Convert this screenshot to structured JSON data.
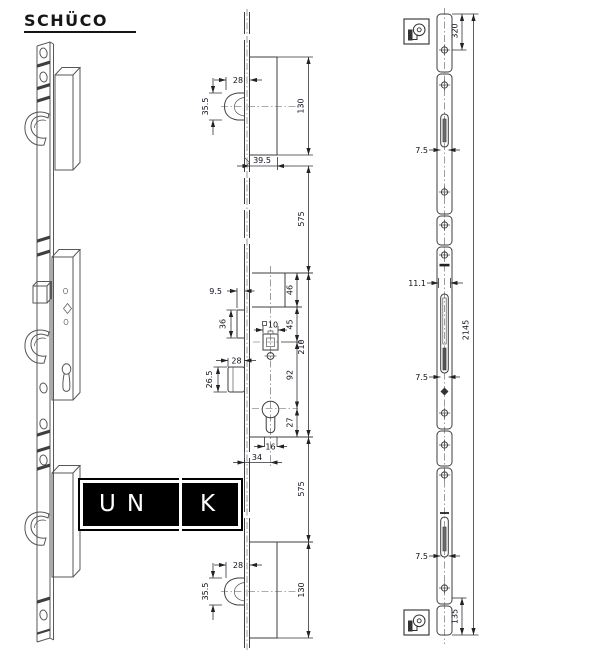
{
  "brand": {
    "name": "SCHÜCO"
  },
  "unik": {
    "full_text": "UNIK",
    "before_bar": "UN",
    "after_bar": "K"
  },
  "colors": {
    "line": "#3d3d3d",
    "dimension_text": "#10101c",
    "logo_bg": "#000000",
    "logo_text": "#ffffff"
  },
  "middle_drawing": {
    "top": {
      "hook_projection": "28",
      "hook_height": "35.5",
      "case_height": "130",
      "offset": "39.5"
    },
    "upper_span": "575",
    "center": {
      "tab_projection": "9.5",
      "tab_height": "36",
      "ref_to_case": "46",
      "case_to_follower": "45",
      "follower_square": "10",
      "latch_projection": "28",
      "latch_height": "26.5",
      "follower_to_cylinder": "92",
      "case_length": "210",
      "cylinder_to_ref": "27",
      "slot_width": "16",
      "backset": "34"
    },
    "lower_span": "575",
    "bottom": {
      "hook_projection": "28",
      "hook_height": "35.5",
      "case_height": "130"
    }
  },
  "right_drawing": {
    "top_offset": "320",
    "slot_clearance_top": "7.5",
    "guide_width": "11.1",
    "overall_length": "2145",
    "slot_clearance_mid": "7.5",
    "slot_clearance_bottom": "7.5",
    "bottom_offset": "135"
  }
}
